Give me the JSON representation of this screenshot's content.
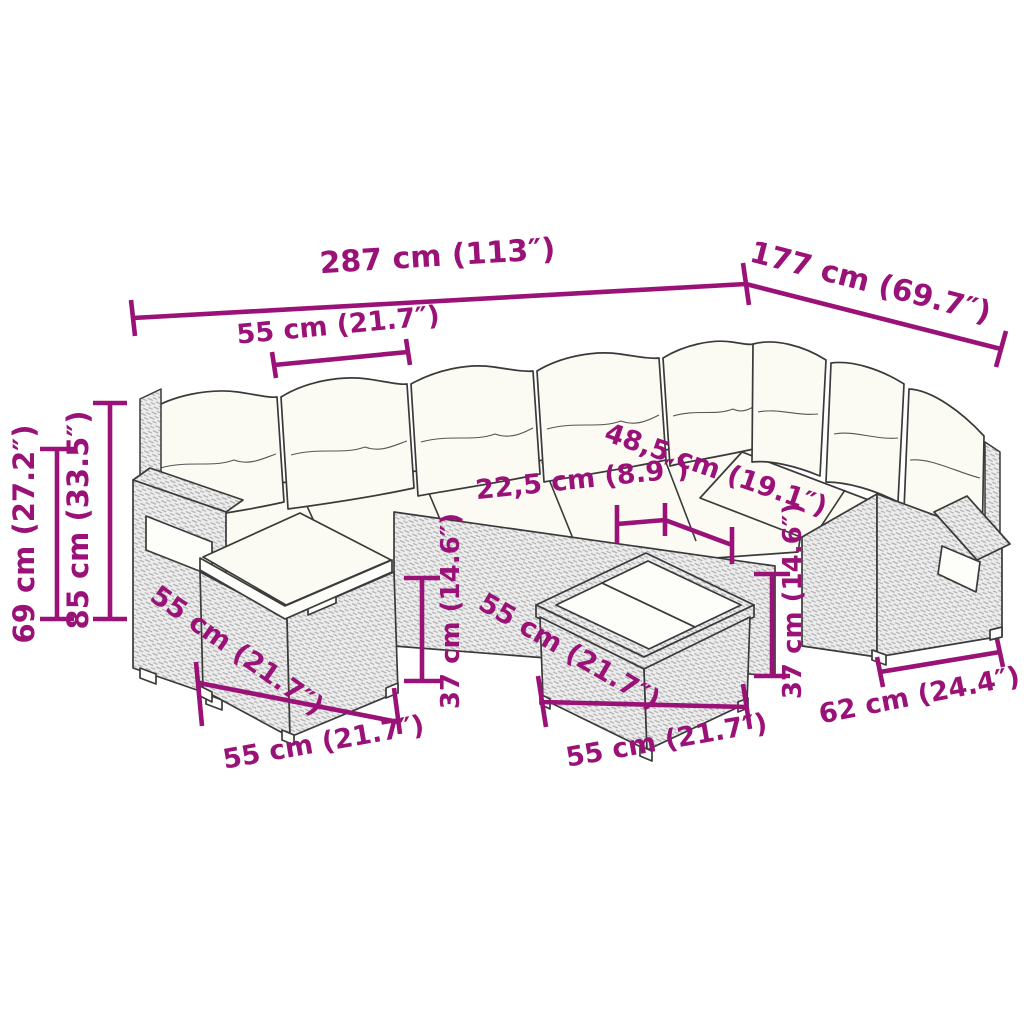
{
  "figure": {
    "description": "Dimension diagram of L-shaped poly rattan garden lounge set with back cushions, ottoman and glass-top coffee table"
  },
  "colors": {
    "accent": "#9A1277",
    "line": "#3A3A3A",
    "rattan_fill": "#ECECEC",
    "cushion": "#FBFAF3",
    "background": "#FFFFFF"
  },
  "dims": {
    "total_width": "287 cm (113″)",
    "total_depth": "177 cm (69.7″)",
    "seat_width": "55 cm (21.7″)",
    "armrest_height": "69 cm (27.2″)",
    "total_height": "85 cm (33.5″)",
    "tabletop_panel_depth": "22,5 cm (8.9″)",
    "tabletop_width": "48,5 cm (19.1″)",
    "seat_height_left": "37 cm (14.6″)",
    "seat_height_right": "37 cm (14.6″)",
    "ottoman_side_depth": "55 cm (21.7″)",
    "ottoman_front_width": "55 cm (21.7″)",
    "table_side_depth": "55 cm (21.7″)",
    "table_front_width": "55 cm (21.7″)",
    "corner_module_width": "62 cm (24.4″)"
  }
}
